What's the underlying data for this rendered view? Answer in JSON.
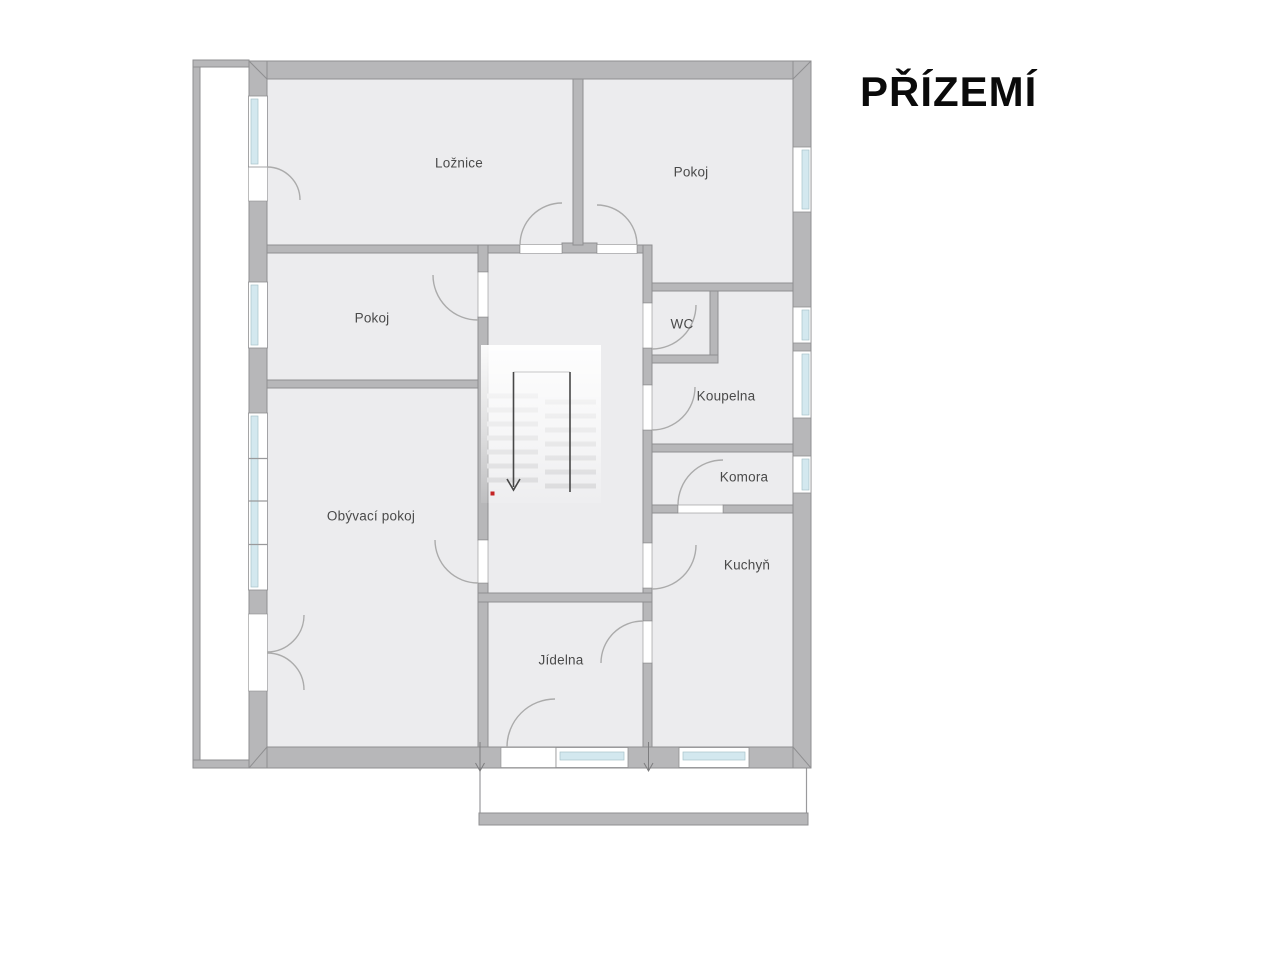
{
  "title": "PŘÍZEMÍ",
  "rooms": {
    "loznice": "Ložnice",
    "pokoj_top": "Pokoj",
    "pokoj_left": "Pokoj",
    "wc": "WC",
    "koupelna": "Koupelna",
    "komora": "Komora",
    "obyvaci_pokoj": "Obývací pokoj",
    "kuchyn": "Kuchyň",
    "jidelna": "Jídelna"
  },
  "colors": {
    "wall": "#b7b7b9",
    "wall_edge": "#8f8f91",
    "room_fill": "#ececee",
    "window_glass": "#d3e8ef",
    "door_arc": "#ababab",
    "stair_line": "#474747",
    "marker_red": "#c42323",
    "label": "#4a4a4a",
    "title": "#0a0a0a"
  }
}
